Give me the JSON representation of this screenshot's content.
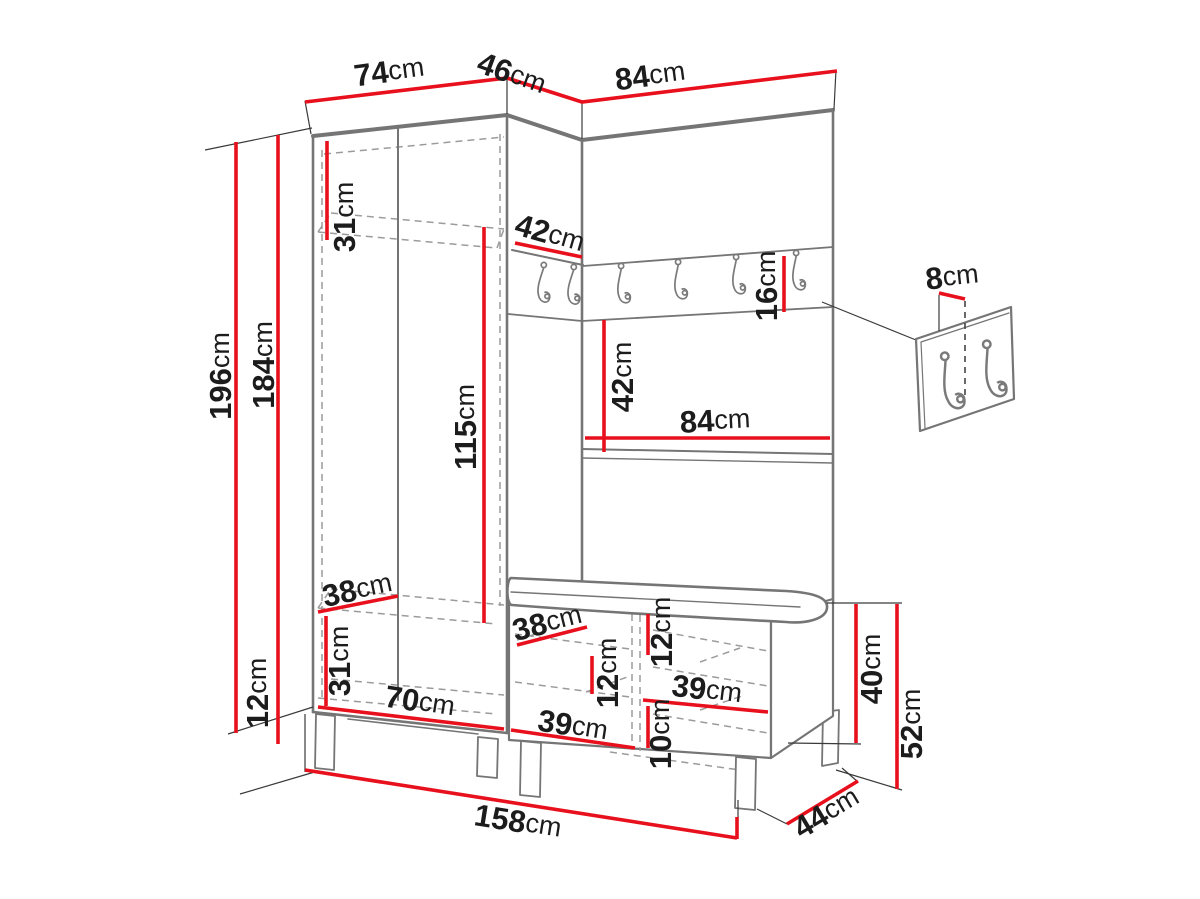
{
  "meta": {
    "title": "Hallway furniture set dimension diagram",
    "unit": "cm"
  },
  "colors": {
    "dimension_red": "#e8101c",
    "outline_gray": "#757575",
    "label_black": "#1c1c1c"
  },
  "dims": {
    "wardrobe_top_width": {
      "value": "74",
      "unit": "cm"
    },
    "corner_top_width": {
      "value": "46",
      "unit": "cm"
    },
    "panel_top_width": {
      "value": "84",
      "unit": "cm"
    },
    "total_height": {
      "value": "196",
      "unit": "cm"
    },
    "body_height": {
      "value": "184",
      "unit": "cm"
    },
    "leg_height": {
      "value": "12",
      "unit": "cm"
    },
    "top_shelf_height": {
      "value": "31",
      "unit": "cm"
    },
    "hanging_space_height": {
      "value": "115",
      "unit": "cm"
    },
    "corner_shelf_width": {
      "value": "42",
      "unit": "cm"
    },
    "rail_height": {
      "value": "16",
      "unit": "cm"
    },
    "panel_opening_height": {
      "value": "42",
      "unit": "cm"
    },
    "panel_shelf_width": {
      "value": "84",
      "unit": "cm"
    },
    "hook_spacing": {
      "value": "8",
      "unit": "cm"
    },
    "wardrobe_bottom_depth": {
      "value": "38",
      "unit": "cm"
    },
    "bottom_shelf_height": {
      "value": "31",
      "unit": "cm"
    },
    "wardrobe_inner_width": {
      "value": "70",
      "unit": "cm"
    },
    "bench_depth": {
      "value": "38",
      "unit": "cm"
    },
    "bench_right_shelf_gap": {
      "value": "12",
      "unit": "cm"
    },
    "bench_left_shelf_gap": {
      "value": "12",
      "unit": "cm"
    },
    "bench_right_width": {
      "value": "39",
      "unit": "cm"
    },
    "bench_bottom_gap": {
      "value": "10",
      "unit": "cm"
    },
    "bench_left_width": {
      "value": "39",
      "unit": "cm"
    },
    "bench_body_height": {
      "value": "40",
      "unit": "cm"
    },
    "bench_total_height": {
      "value": "52",
      "unit": "cm"
    },
    "bench_total_depth": {
      "value": "44",
      "unit": "cm"
    },
    "total_width": {
      "value": "158",
      "unit": "cm"
    }
  }
}
